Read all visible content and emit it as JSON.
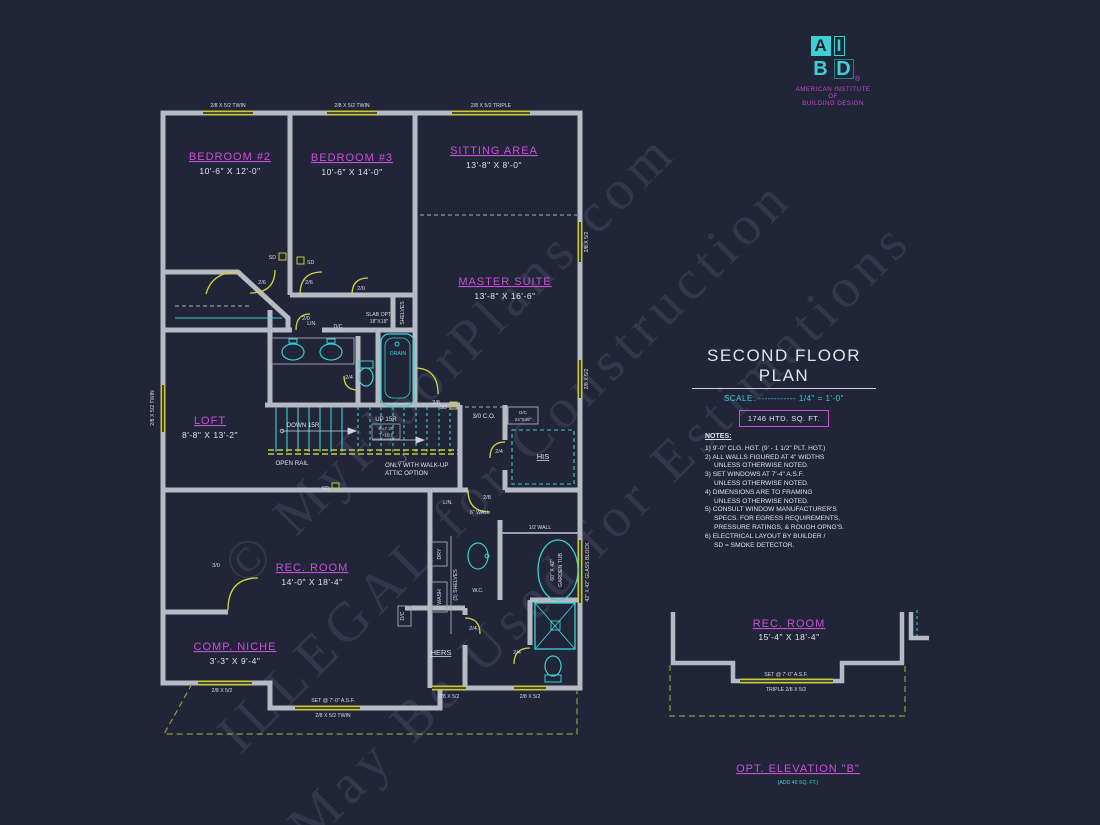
{
  "colors": {
    "background": "#212538",
    "wall_gray": "#b6bac4",
    "fixture_cyan": "#3ccfcf",
    "label_magenta": "#c94fd6",
    "window_yellow": "#c9c937",
    "text_white": "#dfe3ec"
  },
  "logo": {
    "letter_a": "A",
    "letter_i": "I",
    "letter_b": "B",
    "letter_d": "D",
    "registered": "®",
    "org_line1": "AMERICAN INSTITUTE",
    "org_line2": "OF",
    "org_line3": "BUILDING DESIGN"
  },
  "title_block": {
    "title": "SECOND FLOOR PLAN",
    "scale": "SCALE: ------------ 1/4\" = 1'-0\"",
    "sqft": "1746 HTD. SQ. FT."
  },
  "notes": {
    "heading": "NOTES:",
    "lines": [
      "1) 9'-0\" CLG. HGT. (9' - 1 1/2\" PLT. HGT.)",
      "2) ALL WALLS FIGURED AT 4\" WIDTHS",
      "UNLESS OTHERWISE NOTED.",
      "3) SET WINDOWS AT 7'-4\" A.S.F.",
      "UNLESS OTHERWISE NOTED.",
      "4) DIMENSIONS ARE TO FRAMING",
      "UNLESS OTHERWISE NOTED.",
      "5) CONSULT WINDOW MANUFACTURER'S",
      "SPECS. FOR EGRESS REQUIREMENTS,",
      "PRESSURE RATINGS, & ROUGH OPNG'S.",
      "6) ELECTRICAL LAYOUT BY BUILDER /",
      "SD = SMOKE DETECTOR."
    ]
  },
  "rooms": {
    "bedroom2": {
      "name": "BEDROOM #2",
      "dims": "10'-6\" X 12'-0\""
    },
    "bedroom3": {
      "name": "BEDROOM #3",
      "dims": "10'-6\" X 14'-0\""
    },
    "sitting": {
      "name": "SITTING AREA",
      "dims": "13'-8\" X 8'-0\""
    },
    "master": {
      "name": "MASTER SUITE",
      "dims": "13'-8\" X 16'-6\""
    },
    "loft": {
      "name": "LOFT",
      "dims": "8'-8\" X 13'-2\""
    },
    "rec": {
      "name": "REC. ROOM",
      "dims": "14'-0\" X 18'-4\""
    },
    "comp": {
      "name": "COMP. NICHE",
      "dims": "3'-3\" X 9'-4\""
    },
    "his": "HIS",
    "hers": "HERS",
    "lin": "LIN."
  },
  "stairs": {
    "down": "DOWN 15R",
    "up": "UP 15R",
    "riser": "R=7.25",
    "tread": "T=10.5",
    "open_rail": "OPEN RAIL",
    "attic_line1": "ONLY WITH WALK-UP",
    "attic_line2": "ATTIC OPTION"
  },
  "windows": {
    "twin": "2/8 X 5/2 TWIN",
    "triple": "2/8 X 5/2 TRIPLE",
    "single": "2/8 X 5/2",
    "set_asf": "SET @ 7'-0\" A.S.F."
  },
  "doors": {
    "d20": "2/0",
    "d24": "2/4",
    "d26": "2/6",
    "d28": "2/8",
    "d30": "3/0"
  },
  "annotations": {
    "sd": "SD",
    "cased_opening": "3/0 C.O.",
    "dc": "D/C",
    "dc_size": "24\"X36\"",
    "slab_line1": "SLAB OPT.",
    "slab_line2": "18\"X18\"",
    "drain": "DRAIN",
    "shelves": "SHELVES",
    "shelves3": "(3) SHELVES",
    "dry": "DRY",
    "wash": "WASH",
    "wc": "W.C.",
    "wall6": "6\" WALL",
    "wall_half": "1/2 WALL",
    "garden_tub_line1": "60\" X 42\"",
    "garden_tub_line2": "GARDEN TUB",
    "glass_block": "42\" X 42\" GLASS BLOCK"
  },
  "section": {
    "title": "REC. ROOM",
    "dims": "15'-4\" X 18'-4\"",
    "set_asf": "SET @ 7'-0\" A.S.F.",
    "window": "TRIPLE 2/8 X 5/2"
  },
  "elevation": {
    "title": "OPT. ELEVATION \"B\"",
    "subtitle": "(ADD 40 SQ. FT.)"
  },
  "watermarks": {
    "line1": "© MyFloorPlans.com",
    "line2": "ILLEGAL for Construction",
    "line3": "May Be Used for Estimations"
  }
}
